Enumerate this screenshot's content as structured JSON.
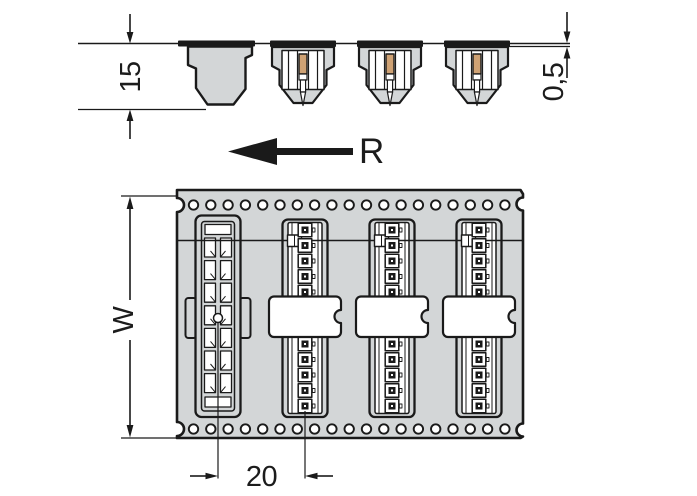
{
  "side_view": {
    "dim_height": "15",
    "dim_tape_thickness": "0,5",
    "unreeling_label": "R"
  },
  "top_view": {
    "dim_width": "W",
    "dim_pitch": "20"
  },
  "counts": {
    "connectors_side_view": 3,
    "empty_pockets_side_view": 1,
    "pockets_top_view": 4,
    "pin_cavities_above_band": 5,
    "pin_cavities_below_band": 5,
    "sprocket_holes_per_row": 19,
    "pocket1_slots_per_column": 7
  },
  "colors": {
    "tape_gray": "#d3d6d7",
    "pin_copper": "#cfa274",
    "line": "#1a1a1a",
    "background": "#ffffff"
  }
}
